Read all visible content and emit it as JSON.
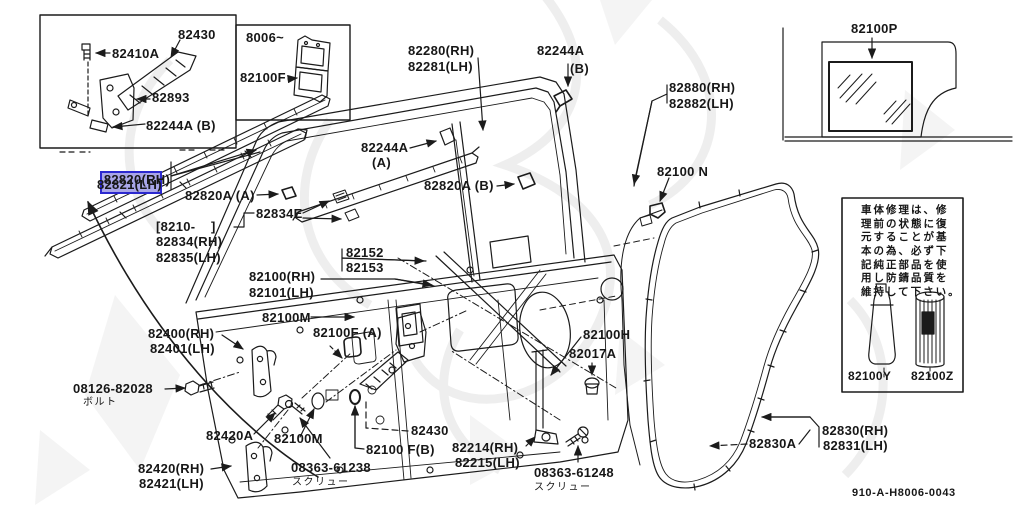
{
  "colors": {
    "paper": "#ffffff",
    "ink": "#1b1b1b",
    "watermark": "#e3e3e3",
    "highlight_fill": "#a9a6e8",
    "highlight_border": "#2b28cf"
  },
  "insets": {
    "door_check": {
      "p82430": "82430",
      "p82410a": "82410A",
      "p82893": "82893",
      "p82244a_b": "82244A (B)"
    },
    "shim": {
      "range": "8006~",
      "part": "82100F"
    },
    "glass": {
      "part": "82100P"
    }
  },
  "labels": {
    "w82820rh": "82820(RH)",
    "w82821lh": "82821(LH)",
    "w82820a_a": "82820A (A)",
    "w82820a_b": "82820A (B)",
    "range8210": "[8210-    ]",
    "w82834rh": "82834(RH)",
    "w82835lh": "82835(LH)",
    "w82834e": "82834E",
    "w82280rh": "82280(RH)",
    "w82281lh": "82281(LH)",
    "w82244a_top": "82244A",
    "w82244a_top_sub": "(B)",
    "w82244a_left": "82244A",
    "w82244a_left_sub": "(A)",
    "w82880rh": "82880(RH)",
    "w82882lh": "82882(LH)",
    "w82100n": "82100 N",
    "w82152": "82152",
    "w82153": "82153",
    "w82100rh": "82100(RH)",
    "w82101lh": "82101(LH)",
    "w82100m_mid": "82100M",
    "w82100f_a": "82100F (A)",
    "w82100h": "82100H",
    "w82017a": "82017A",
    "w82400rh": "82400(RH)",
    "w82401lh": "82401(LH)",
    "w08126": "08126-82028",
    "jp_bolt": "ボルト",
    "w82420a": "82420A",
    "w82100m_bl": "82100M",
    "w82420rh": "82420(RH)",
    "w82421lh": "82421(LH)",
    "w08363_61238": "08363-61238",
    "jp_screw1": "スクリュー",
    "w82430b": "82430",
    "w82100f_b": "82100 F(B)",
    "w82214rh": "82214(RH)",
    "w82215lh": "82215(LH)",
    "w08363_61248": "08363-61248",
    "jp_screw2": "スクリュー",
    "w82830a": "82830A",
    "w82830rh": "82830(RH)",
    "w82831lh": "82831(LH)"
  },
  "note_box": {
    "line1": "車体修理は、修",
    "line2": "理前の状態に復",
    "line3": "元することが基",
    "line4": "本の為、必ず下",
    "line5": "記純正部品を使",
    "line6": "用し防錆品質を",
    "line7": "維持して下さい。",
    "tube_part": "82100Y",
    "spray_part": "82100Z"
  },
  "footer": {
    "drawing_no": "910-A-H8006-0043"
  }
}
